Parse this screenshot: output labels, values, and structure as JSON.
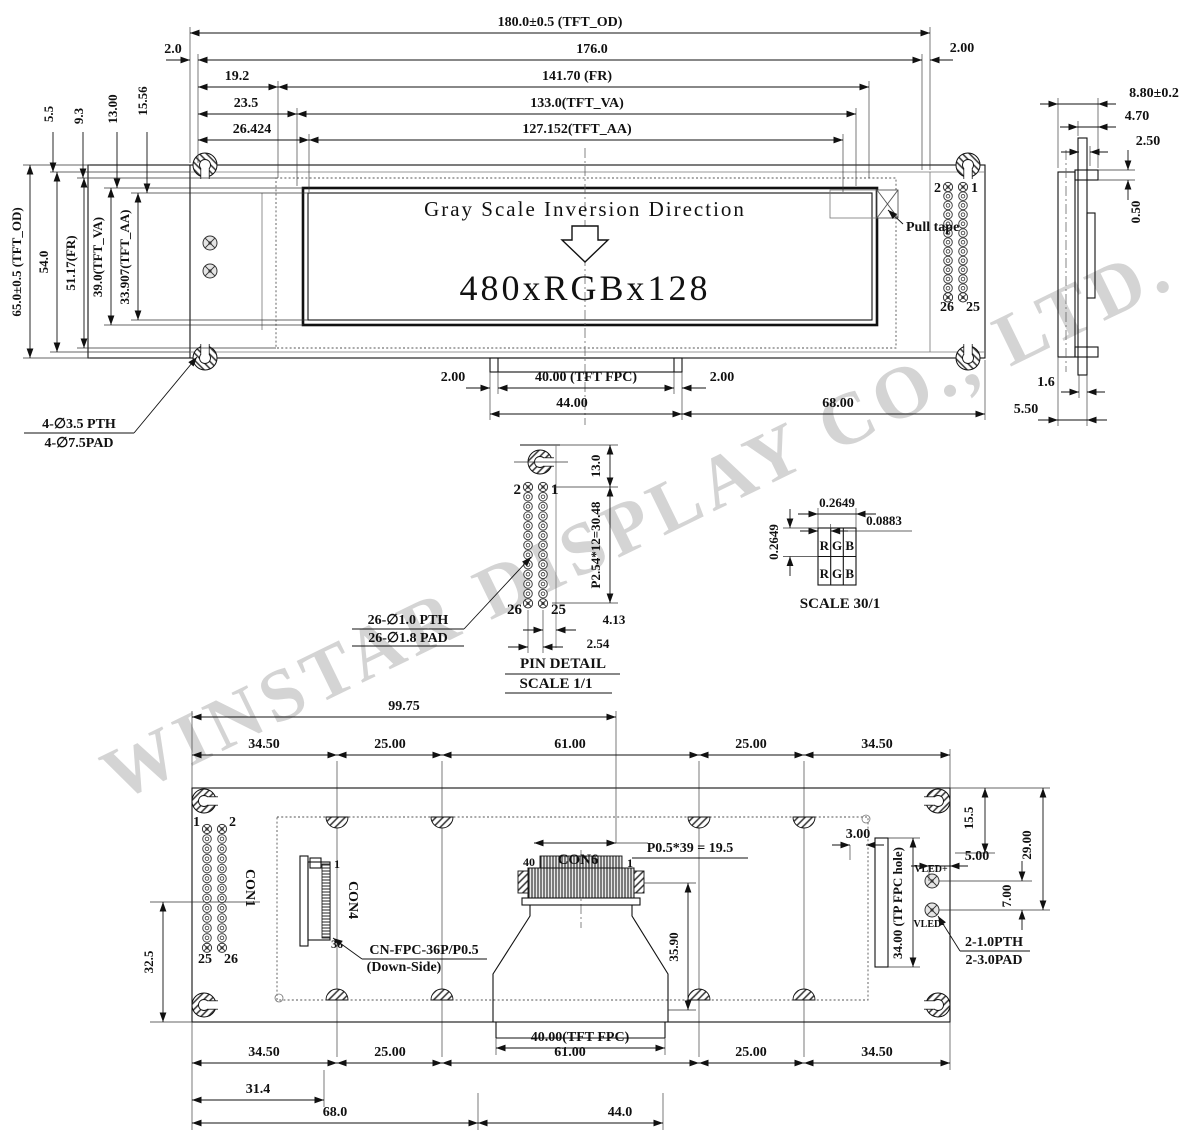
{
  "watermark": "WINSTAR DISPLAY CO., LTD.",
  "front": {
    "screen_line1": "Gray Scale Inversion Direction",
    "screen_line2": "480xRGBx128",
    "pull_tape": "Pull tape",
    "pins": {
      "tl": "2",
      "tr": "1",
      "bl": "26",
      "br": "25"
    },
    "top_dims": {
      "od": "180.0±0.5 (TFT_OD)",
      "g2l": "2.0",
      "w176": "176.0",
      "g2r": "2.00",
      "off19": "19.2",
      "fr": "141.70 (FR)",
      "off23": "23.5",
      "va": "133.0(TFT_VA)",
      "off26": "26.424",
      "aa": "127.152(TFT_AA)"
    },
    "left_dims": {
      "d55": "5.5",
      "d93": "9.3",
      "d13": "13.00",
      "d1556": "15.56",
      "od": "65.0±0.5 (TFT_OD)",
      "d54": "54.0",
      "fr": "51.17(FR)",
      "va": "39.0(TFT_VA)",
      "aa": "33.907(TFT_AA)"
    },
    "bottom_dims": {
      "g1": "2.00",
      "fpc": "40.00 (TFT FPC)",
      "g2": "2.00",
      "d44": "44.00",
      "d68": "68.00"
    },
    "hole_callout1": "4-∅3.5 PTH",
    "hole_callout2": "4-∅7.5PAD"
  },
  "side": {
    "d88": "8.80±0.2",
    "d47": "4.70",
    "d25": "2.50",
    "d05": "0.50",
    "d16": "1.6",
    "d550": "5.50"
  },
  "pin_detail": {
    "d13": "13.0",
    "pitch": "P2.54*12=30.48",
    "d413": "4.13",
    "d254": "2.54",
    "pth": "26-∅1.0 PTH",
    "pad": "26-∅1.8 PAD",
    "pins": {
      "tl": "2",
      "tr": "1",
      "bl": "26",
      "br": "25"
    },
    "title": "PIN DETAIL",
    "scale": "SCALE 1/1"
  },
  "rgb_detail": {
    "w": "0.2649",
    "sub": "0.0883",
    "h": "0.2649",
    "r": "R",
    "g": "G",
    "b": "B",
    "scale": "SCALE 30/1"
  },
  "back": {
    "d9975": "99.75",
    "top": [
      "34.50",
      "25.00",
      "61.00",
      "25.00",
      "34.50"
    ],
    "bottom": [
      "34.50",
      "25.00",
      "61.00",
      "25.00",
      "34.50"
    ],
    "d155": "15.5",
    "d29": "29.00",
    "d3": "3.00",
    "d5": "5.00",
    "d7": "7.00",
    "d325": "32.5",
    "fpc40": "40.00(TFT FPC)",
    "d314": "31.4",
    "d68": "68.0",
    "d44": "44.0",
    "con1": "CON1",
    "con4": "CON4",
    "con6": "CON6",
    "con1_pins": {
      "p1": "1",
      "p2": "2",
      "p25": "25",
      "p26": "26"
    },
    "con4_pins": {
      "p1": "1",
      "p36": "36"
    },
    "con6_pins": {
      "p40": "40",
      "p1": "1"
    },
    "pitch": "P0.5*39 = 19.5",
    "d359": "35.90",
    "tp_hole": "34.00 (TP FPC hole)",
    "vled_p": "VLED+",
    "vled_m": "VLED-",
    "pth": "2-1.0PTH",
    "pad": "2-3.0PAD",
    "cn_fpc": "CN-FPC-36P/P0.5",
    "down_side": "(Down-Side)"
  }
}
